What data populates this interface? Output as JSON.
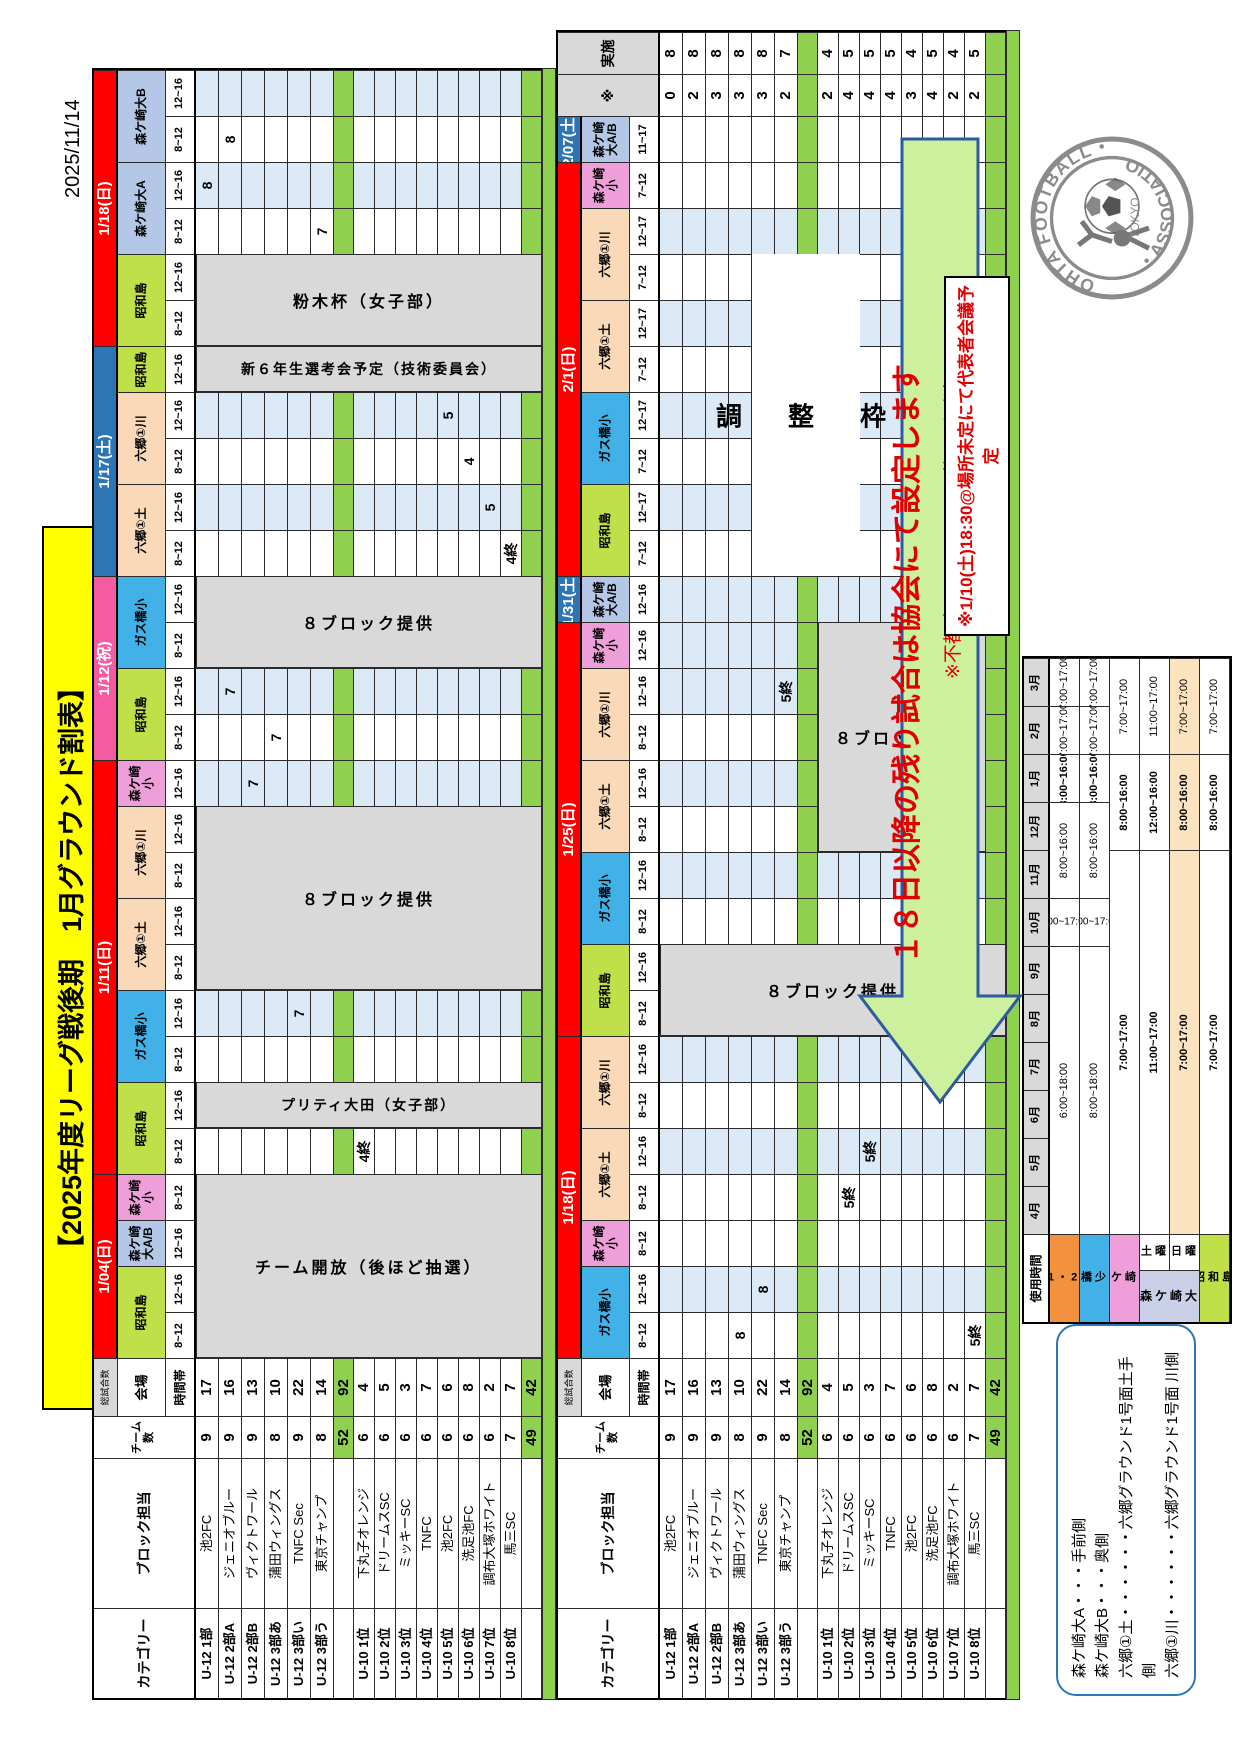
{
  "meta": {
    "print_date": "2025/11/14",
    "title": "【2025年度リーグ戦後期　1月グラウンド割表】"
  },
  "notice": "※1/10(土)18:30@場所未定にて代表者会議予定",
  "arrow": {
    "main": "１８日以降の残り試合は協会にて設定します",
    "note": "※不都合日アンケートは後ほど別途メールにて"
  },
  "big_box_label": "調　整　枠",
  "legend": {
    "lines": [
      "森ケ崎大A・・・手前側",
      "森ケ崎大B・・・奥側",
      "六郷①土・・・・・・六郷グラウンド1号面土手側",
      "六郷①川・・・・・・六郷グラウンド1号面 川側"
    ]
  },
  "logo": {
    "arc_top": "OHTA FOOTBALL",
    "arc_bottom": "ASSOCIATION",
    "center": "TOKYO"
  },
  "colors": {
    "red": "#ff0000",
    "saturday_blue": "#2e75b6",
    "holiday_pink": "#f45ba0",
    "showajima": "#bfe049",
    "morigasaki_dai": "#b4c7e7",
    "morigasaki_sho": "#ee9fd9",
    "gasubashi": "#41b1e8",
    "rokugo": "#f9d9b8",
    "cell_blue": "#dce9f6",
    "grey_block": "#d9d9d9",
    "subtotal_green": "#8fd14f",
    "arrow_fill": "#ccf09e",
    "arrow_stroke": "#2e5aa0",
    "title_yellow": "#ffff00"
  },
  "left_headers": {
    "category": "カテゴリー",
    "block": "ブロック担当",
    "teams": "チーム数",
    "total": "総試合数",
    "venue": "会場",
    "time": "時間帯"
  },
  "rows": [
    {
      "cat": "U-12 1部",
      "team": "池2FC",
      "n": "9",
      "tot": "17",
      "st": "0",
      "ex": "8"
    },
    {
      "cat": "U-12 2部A",
      "team": "ジェニオブルー",
      "n": "9",
      "tot": "16",
      "st": "2",
      "ex": "8"
    },
    {
      "cat": "U-12 2部B",
      "team": "ヴィクトワール",
      "n": "9",
      "tot": "13",
      "st": "3",
      "ex": "8"
    },
    {
      "cat": "U-12 3部あ",
      "team": "蒲田ウィングス",
      "n": "8",
      "tot": "10",
      "st": "3",
      "ex": "8"
    },
    {
      "cat": "U-12 3部い",
      "team": "TNFC Sec",
      "n": "9",
      "tot": "22",
      "st": "3",
      "ex": "8"
    },
    {
      "cat": "U-12 3部う",
      "team": "東京チャンプ",
      "n": "8",
      "tot": "14",
      "st": "2",
      "ex": "7"
    },
    {
      "sub": true,
      "n": "52",
      "tot": "92"
    },
    {
      "cat": "U-10 1位",
      "team": "下丸子オレンジ",
      "n": "6",
      "tot": "4",
      "st": "2",
      "ex": "4"
    },
    {
      "cat": "U-10 2位",
      "team": "ドリームスSC",
      "n": "6",
      "tot": "5",
      "st": "4",
      "ex": "5"
    },
    {
      "cat": "U-10 3位",
      "team": "ミッキーSC",
      "n": "6",
      "tot": "3",
      "st": "4",
      "ex": "5"
    },
    {
      "cat": "U-10 4位",
      "team": "TNFC",
      "n": "6",
      "tot": "7",
      "st": "4",
      "ex": "5"
    },
    {
      "cat": "U-10 5位",
      "team": "池2FC",
      "n": "6",
      "tot": "6",
      "st": "3",
      "ex": "4"
    },
    {
      "cat": "U-10 6位",
      "team": "洗足池FC",
      "n": "6",
      "tot": "8",
      "st": "4",
      "ex": "5"
    },
    {
      "cat": "U-10 7位",
      "team": "調布大塚ホワイト",
      "n": "6",
      "tot": "2",
      "st": "2",
      "ex": "4"
    },
    {
      "cat": "U-10 8位",
      "team": "馬三SC",
      "n": "7",
      "tot": "7",
      "st": "2",
      "ex": "5"
    },
    {
      "sub": true,
      "n": "49",
      "tot": "42"
    }
  ],
  "tables": [
    {
      "name": "january-first-half",
      "groups": [
        {
          "date": "1/04(日)",
          "color": "red",
          "venues": [
            {
              "name": "昭和島",
              "color": "showajima",
              "slots": [
                "8~12",
                "12~16"
              ]
            },
            {
              "name": "森ケ崎大A/B",
              "color": "morigasaki_dai",
              "slots": [
                "12~16"
              ]
            },
            {
              "name": "森ケ崎小",
              "color": "morigasaki_sho",
              "slots": [
                "8~12"
              ]
            }
          ]
        },
        {
          "date": "1/11(日)",
          "color": "red",
          "venues": [
            {
              "name": "昭和島",
              "color": "showajima",
              "slots": [
                "8~12",
                "12~16"
              ]
            },
            {
              "name": "ガス橋小",
              "color": "gasubashi",
              "slots": [
                "8~12",
                "12~16"
              ]
            },
            {
              "name": "六郷①土",
              "color": "rokugo",
              "slots": [
                "8~12",
                "12~16"
              ]
            },
            {
              "name": "六郷①川",
              "color": "rokugo",
              "slots": [
                "8~12",
                "12~16"
              ]
            },
            {
              "name": "森ケ崎小",
              "color": "morigasaki_sho",
              "slots": [
                "12~16"
              ]
            }
          ]
        },
        {
          "date": "1/12(祝)",
          "color": "holiday_pink",
          "venues": [
            {
              "name": "昭和島",
              "color": "showajima",
              "slots": [
                "8~12",
                "12~16"
              ]
            },
            {
              "name": "ガス橋小",
              "color": "gasubashi",
              "slots": [
                "8~12",
                "12~16"
              ]
            }
          ]
        },
        {
          "date": "1/17(土)",
          "color": "saturday_blue",
          "venues": [
            {
              "name": "六郷①土",
              "color": "rokugo",
              "slots": [
                "8~12",
                "12~16"
              ]
            },
            {
              "name": "六郷①川",
              "color": "rokugo",
              "slots": [
                "8~12",
                "12~16"
              ]
            },
            {
              "name": "昭和島",
              "color": "showajima",
              "slots": [
                "12~16"
              ]
            }
          ]
        },
        {
          "date": "1/18(日)",
          "color": "red",
          "venues": [
            {
              "name": "昭和島",
              "color": "showajima",
              "slots": [
                "8~12",
                "12~16"
              ]
            },
            {
              "name": "森ケ崎大A",
              "color": "morigasaki_dai",
              "slots": [
                "8~12",
                "12~16"
              ]
            },
            {
              "name": "森ケ崎大B",
              "color": "morigasaki_dai",
              "slots": [
                "8~12",
                "12~16"
              ]
            }
          ]
        }
      ],
      "annotations": {
        "7-4": "4終",
        "4-7": "7",
        "2-12": "7",
        "3-13": "7",
        "1-14": "7",
        "14-17": "4終",
        "13-18": "5",
        "12-19": "4",
        "11-20": "5",
        "5-24": "7",
        "0-25": "8",
        "1-26": "8"
      },
      "blocks": [
        {
          "c": 0,
          "span": 4,
          "r": 0,
          "rs": 16,
          "text": "チーム開放（後ほど抽選）",
          "bg": "grey"
        },
        {
          "c": 5,
          "span": 1,
          "r": 0,
          "rs": 16,
          "text": "プリティ大田（女子部）",
          "bg": "grey"
        },
        {
          "c": 8,
          "span": 4,
          "r": 0,
          "rs": 16,
          "text": "８ブロック提供",
          "bg": "grey"
        },
        {
          "c": 15,
          "span": 2,
          "r": 0,
          "rs": 16,
          "text": "８ブロック提供",
          "bg": "grey"
        },
        {
          "c": 21,
          "span": 1,
          "r": 0,
          "rs": 16,
          "text": "新６年生選考会予定（技術委員会）",
          "bg": "grey"
        },
        {
          "c": 22,
          "span": 2,
          "r": 0,
          "rs": 16,
          "text": "粉木杯（女子部）",
          "bg": "grey"
        }
      ]
    },
    {
      "name": "january-second-half",
      "extra": {
        "star": "※",
        "done": "実施"
      },
      "groups": [
        {
          "date": "1/18(日)",
          "color": "red",
          "venues": [
            {
              "name": "ガス橋小",
              "color": "gasubashi",
              "slots": [
                "8~12",
                "12~16"
              ]
            },
            {
              "name": "森ケ崎小",
              "color": "morigasaki_sho",
              "slots": [
                "8~12"
              ]
            },
            {
              "name": "六郷①土",
              "color": "rokugo",
              "slots": [
                "8~12",
                "12~16"
              ]
            },
            {
              "name": "六郷①川",
              "color": "rokugo",
              "slots": [
                "8~12",
                "12~16"
              ]
            }
          ]
        },
        {
          "date": "1/25(日)",
          "color": "red",
          "venues": [
            {
              "name": "昭和島",
              "color": "showajima",
              "slots": [
                "8~12",
                "12~16"
              ]
            },
            {
              "name": "ガス橋小",
              "color": "gasubashi",
              "slots": [
                "8~12",
                "12~16"
              ]
            },
            {
              "name": "六郷①土",
              "color": "rokugo",
              "slots": [
                "8~12",
                "12~16"
              ]
            },
            {
              "name": "六郷①川",
              "color": "rokugo",
              "slots": [
                "8~12",
                "12~16"
              ]
            },
            {
              "name": "森ケ崎小",
              "color": "morigasaki_sho",
              "slots": [
                "12~16"
              ]
            }
          ]
        },
        {
          "date": "1/31(土)",
          "color": "saturday_blue",
          "venues": [
            {
              "name": "森ケ崎大A/B",
              "color": "morigasaki_dai",
              "slots": [
                "12~16"
              ]
            }
          ]
        },
        {
          "date": "2/1(日)",
          "color": "red",
          "venues": [
            {
              "name": "昭和島",
              "color": "showajima",
              "slots": [
                "7~12",
                "12~17"
              ]
            },
            {
              "name": "ガス橋小",
              "color": "gasubashi",
              "slots": [
                "7~12",
                "12~17"
              ]
            },
            {
              "name": "六郷①土",
              "color": "rokugo",
              "slots": [
                "7~12",
                "12~17"
              ]
            },
            {
              "name": "六郷①川",
              "color": "rokugo",
              "slots": [
                "7~12",
                "12~17"
              ]
            },
            {
              "name": "森ケ崎小",
              "color": "morigasaki_sho",
              "slots": [
                "7~12"
              ]
            }
          ]
        },
        {
          "date": "2/07(土)",
          "color": "saturday_blue",
          "venues": [
            {
              "name": "森ケ崎大A/B",
              "color": "morigasaki_dai",
              "slots": [
                "11~17"
              ]
            }
          ]
        }
      ],
      "annotations": {
        "3-0": "8",
        "4-1": "8",
        "14-0": "5終",
        "8-3": "5終",
        "9-4": "5終",
        "5-14": "5終"
      },
      "blocks": [
        {
          "c": 7,
          "span": 2,
          "r": 0,
          "rs": 16,
          "text": "８ブロック提供",
          "bg": "grey"
        },
        {
          "c": 11,
          "span": 5,
          "r": 7,
          "rs": 8,
          "text": "８ブロック提供",
          "bg": "grey"
        },
        {
          "c": 17,
          "span": 7,
          "r": 4,
          "rs": 5,
          "text": "調　整　枠",
          "bg": "white"
        }
      ]
    }
  ],
  "usage": {
    "title": "使用時間",
    "months": [
      "4月",
      "5月",
      "6月",
      "7月",
      "8月",
      "9月",
      "10月",
      "11月",
      "12月",
      "1月",
      "2月",
      "3月"
    ],
    "sat": "土曜",
    "sun": "日曜",
    "rows": [
      {
        "name": "六郷1・2号面",
        "color": "#f4913e",
        "segs": [
          {
            "a": 0,
            "b": 5,
            "t": "6:00~18:00"
          },
          {
            "a": 6,
            "b": 6,
            "t": "7:00~17:00",
            "rot": true
          },
          {
            "a": 7,
            "b": 8,
            "t": "8:00~16:00"
          },
          {
            "a": 9,
            "b": 9,
            "t": "8:00~16:00",
            "big": true
          },
          {
            "a": 10,
            "b": 10,
            "t": "7:00~17:00"
          },
          {
            "a": 11,
            "b": 11,
            "t": "7:00~17:00"
          }
        ]
      },
      {
        "name": "ガス橋少年用",
        "color": "#41b1e8",
        "segs": [
          {
            "a": 0,
            "b": 5,
            "t": "8:00~18:00"
          },
          {
            "a": 6,
            "b": 6,
            "t": "7:00~17:00",
            "rot": true
          },
          {
            "a": 7,
            "b": 8,
            "t": "8:00~16:00"
          },
          {
            "a": 9,
            "b": 9,
            "t": "8:00~16:00",
            "big": true
          },
          {
            "a": 10,
            "b": 10,
            "t": "7:00~17:00"
          },
          {
            "a": 11,
            "b": 11,
            "t": "7:00~17:00"
          }
        ]
      },
      {
        "name": "森ケ崎小",
        "color": "#ee9fd9",
        "segs": [
          {
            "a": 0,
            "b": 7,
            "t": "7:00~17:00",
            "big": true
          },
          {
            "a": 8,
            "b": 9,
            "t": "8:00~16:00",
            "big": true
          },
          {
            "a": 10,
            "b": 11,
            "t": "7:00~17:00"
          }
        ]
      },
      {
        "name": "森ケ崎大",
        "day": "土曜",
        "color": "#c9d0e8",
        "segs": [
          {
            "a": 0,
            "b": 7,
            "t": "11:00~17:00",
            "big": true
          },
          {
            "a": 8,
            "b": 9,
            "t": "12:00~16:00",
            "big": true
          },
          {
            "a": 10,
            "b": 11,
            "t": "11:00~17:00"
          }
        ]
      },
      {
        "name": "森ケ崎大",
        "day": "日曜",
        "color": "#c9d0e8",
        "rowbg": "#fbe3c0",
        "segs": [
          {
            "a": 0,
            "b": 7,
            "t": "7:00~17:00",
            "big": true
          },
          {
            "a": 8,
            "b": 9,
            "t": "8:00~16:00",
            "big": true
          },
          {
            "a": 10,
            "b": 11,
            "t": "7:00~17:00"
          }
        ]
      },
      {
        "name": "昭和島",
        "color": "#bfe049",
        "segs": [
          {
            "a": 0,
            "b": 7,
            "t": "7:00~17:00",
            "big": true
          },
          {
            "a": 8,
            "b": 9,
            "t": "8:00~16:00",
            "big": true
          },
          {
            "a": 10,
            "b": 11,
            "t": "7:00~17:00"
          }
        ]
      }
    ]
  }
}
